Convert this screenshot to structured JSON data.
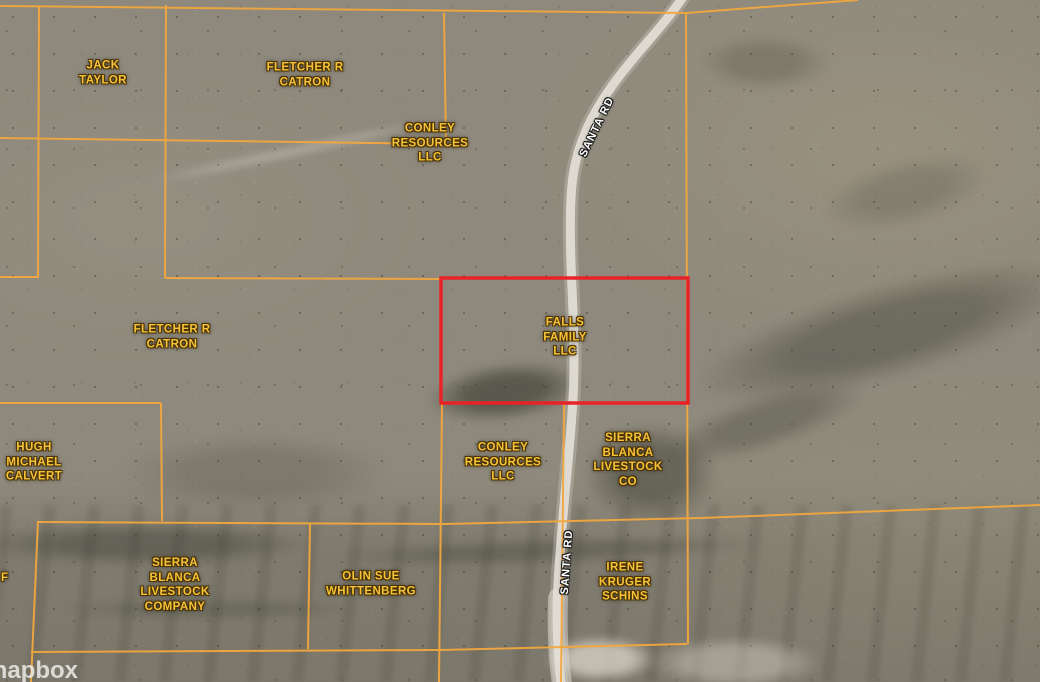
{
  "map": {
    "attribution": "mapbox",
    "colors": {
      "parcel_line": "#f1a73d",
      "highlight_red": "#e82228",
      "label_gold": "#f6c238",
      "road_white": "#e7e4dc"
    },
    "highlight": {
      "owner": "FALLS FAMILY LLC"
    },
    "road": {
      "name": "SANTA RD",
      "labels": [
        {
          "text": "SANTA RD",
          "x": 597,
          "y": 127,
          "rotation": -64
        },
        {
          "text": "SANTA RD",
          "x": 567,
          "y": 562,
          "rotation": -86
        }
      ]
    },
    "parcels": [
      {
        "owner": "JACK TAYLOR",
        "lines": [
          "JACK",
          "TAYLOR"
        ],
        "x": 103,
        "y": 73
      },
      {
        "owner": "FLETCHER R CATRON",
        "lines": [
          "FLETCHER R",
          "CATRON"
        ],
        "x": 305,
        "y": 75
      },
      {
        "owner": "CONLEY RESOURCES LLC",
        "lines": [
          "CONLEY",
          "RESOURCES",
          "LLC"
        ],
        "x": 430,
        "y": 143
      },
      {
        "owner": "FLETCHER R CATRON",
        "lines": [
          "FLETCHER R",
          "CATRON"
        ],
        "x": 172,
        "y": 337
      },
      {
        "owner": "FALLS FAMILY LLC",
        "lines": [
          "FALLS",
          "FAMILY",
          "LLC"
        ],
        "x": 565,
        "y": 337,
        "highlight": true
      },
      {
        "owner": "HUGH MICHAEL CALVERT",
        "lines": [
          "HUGH",
          "MICHAEL",
          "CALVERT"
        ],
        "x": 34,
        "y": 462
      },
      {
        "owner": "CONLEY RESOURCES LLC",
        "lines": [
          "CONLEY",
          "RESOURCES",
          "LLC"
        ],
        "x": 503,
        "y": 462
      },
      {
        "owner": "SIERRA BLANCA LIVESTOCK CO",
        "lines": [
          "SIERRA",
          "BLANCA",
          "LIVESTOCK",
          "CO"
        ],
        "x": 628,
        "y": 460
      },
      {
        "owner": "SIERRA BLANCA LIVESTOCK COMPANY",
        "lines": [
          "SIERRA",
          "BLANCA",
          "LIVESTOCK",
          "COMPANY"
        ],
        "x": 175,
        "y": 585
      },
      {
        "owner": "OLIN SUE WHITTENBERG",
        "lines": [
          "OLIN SUE",
          "WHITTENBERG"
        ],
        "x": 371,
        "y": 584
      },
      {
        "owner": "IRENE KRUGER SCHINS",
        "lines": [
          "IRENE",
          "KRUGER",
          "SCHINS"
        ],
        "x": 625,
        "y": 582
      },
      {
        "owner": "F",
        "lines": [
          "F"
        ],
        "x": 1,
        "y": 578,
        "partial": true
      }
    ]
  }
}
